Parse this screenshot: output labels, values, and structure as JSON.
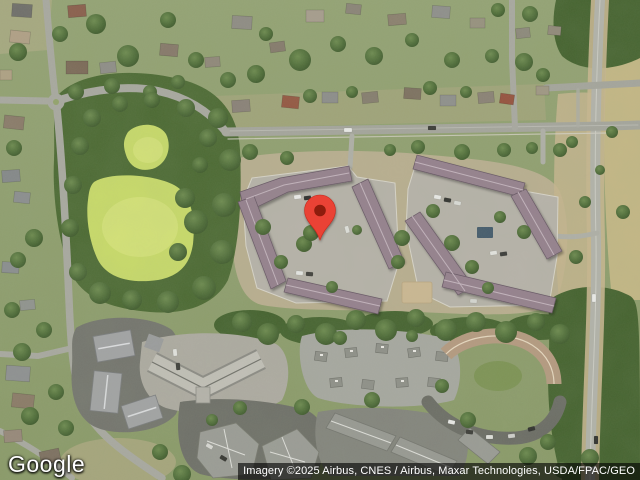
{
  "map": {
    "view_type": "satellite",
    "logo_text": "Google",
    "attribution_text": "Imagery ©2025 Airbus, CNES / Airbus, Maxar Technologies, USDA/FPAC/GEO",
    "marker": {
      "icon": "location-pin",
      "color": "#EA4335",
      "inner_color": "#8E1B0D",
      "position_px": {
        "x": 320,
        "y": 240
      }
    },
    "colors": {
      "park_green": "#C9DB69",
      "tree_green": "#45632F",
      "road_gray": "#A9A9A1",
      "parking_gray": "#B7B3AA",
      "apartment_roof": "#95808E",
      "townhome_roof": "#A3A4A6",
      "attribution_bg": "rgba(0,0,0,0.62)",
      "attribution_fg": "#FFFFFF"
    }
  }
}
